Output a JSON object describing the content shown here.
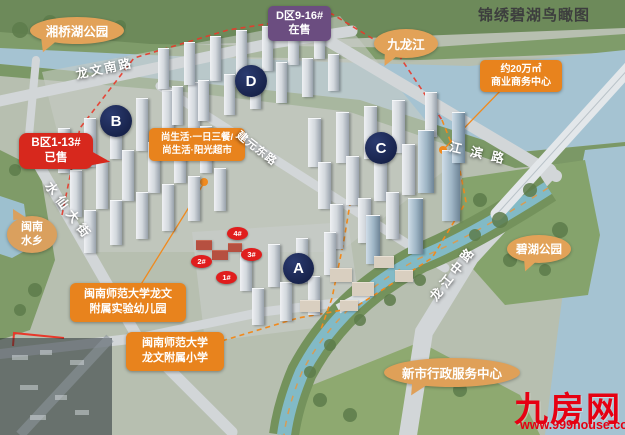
{
  "title": "锦绣碧湖鸟瞰图",
  "sale_labels": {
    "d_zone": {
      "line1": "D区9-16#",
      "line2": "在售"
    },
    "b_zone": {
      "line1": "B区1-13#",
      "line2": "已售"
    }
  },
  "zone_markers": {
    "a": "A",
    "b": "B",
    "c": "C",
    "d": "D"
  },
  "building_numbers": {
    "n1": "1#",
    "n2": "2#",
    "n3": "3#",
    "n4": "4#"
  },
  "amenity_labels": {
    "business_center": {
      "line1": "约20万㎡",
      "line2": "商业商务中心"
    },
    "shang_life": {
      "line1": "尚生活·一日三餐/",
      "line2": "尚生活·阳光超市"
    },
    "kindergarten": {
      "line1": "闽南师范大学龙文",
      "line2": "附属实验幼儿园"
    },
    "primary_school": {
      "line1": "闽南师范大学",
      "line2": "龙文附属小学"
    }
  },
  "place_bubbles": {
    "xiangqiao_park": "湘桥湖公园",
    "jiulong_river": "九龙江",
    "minnan_water_town": {
      "line1": "闽南",
      "line2": "水乡"
    },
    "bihu_park": "碧湖公园",
    "admin_center": "新市行政服务中心"
  },
  "road_labels": {
    "longwen_south": "龙文南路",
    "shuixian_street": "水仙大街",
    "jianyuan_east": "建元东路",
    "jiangbin": "江滨路",
    "longjiang_middle": "龙江中路"
  },
  "watermark": {
    "site_name": "九房网",
    "site_url": "www.999house.com"
  },
  "colors": {
    "accent_orange": "#E8831D",
    "bubble_tan": "#E2A258",
    "sold_red": "#D7281D",
    "onsale_purple": "#6B4D80",
    "zone_navy": "#1E2C58",
    "watermark_red": "#E60012"
  }
}
